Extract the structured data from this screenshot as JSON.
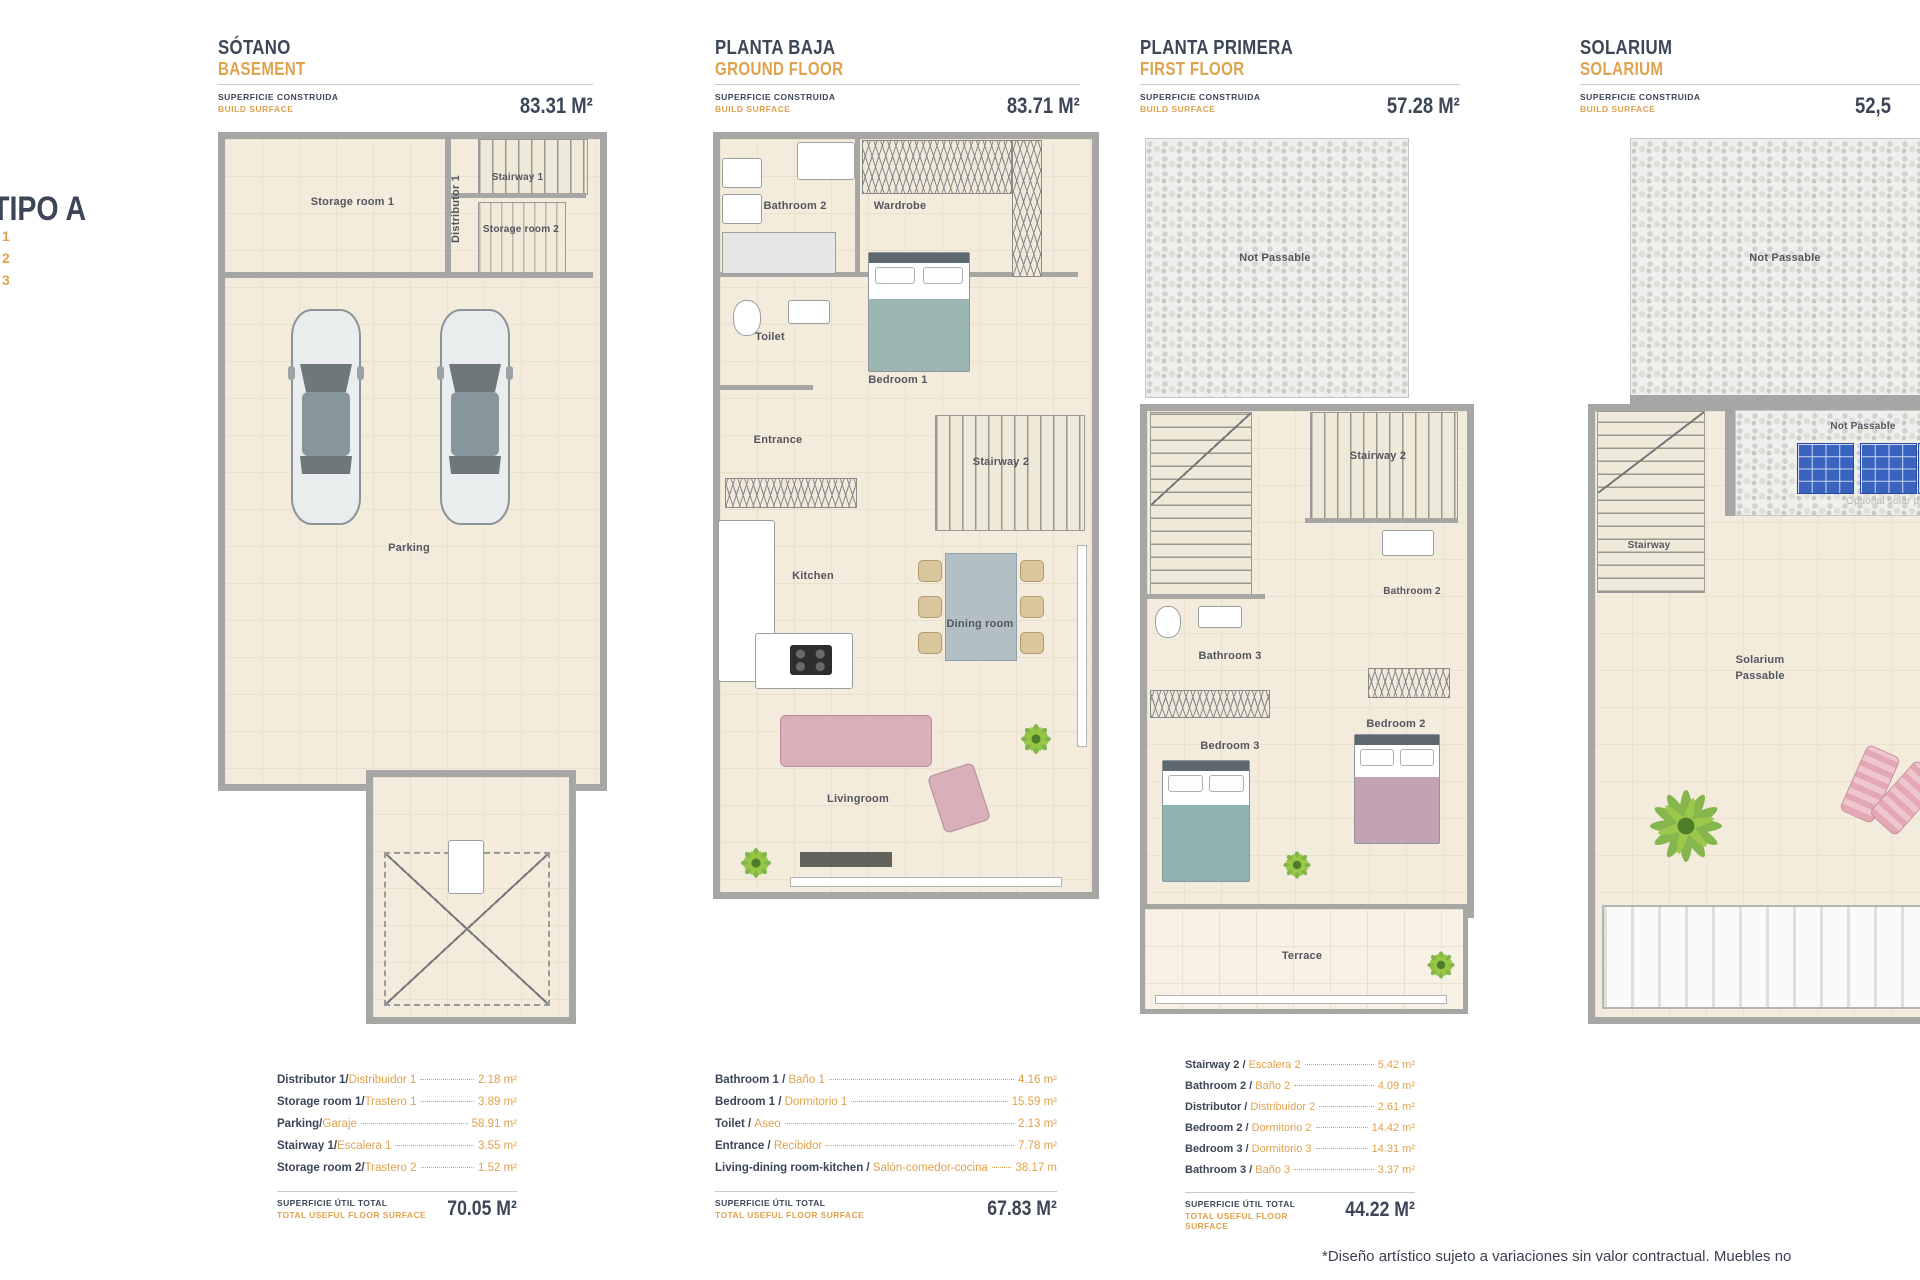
{
  "sidebar": {
    "type_title": "TIPO A",
    "list_items": [
      "1",
      "2",
      "3"
    ]
  },
  "shared": {
    "build_surface_es": "SUPERFICIE CONSTRUIDA",
    "build_surface_en": "BUILD SURFACE",
    "total_es": "SUPERFICIE ÚTIL TOTAL",
    "total_en": "TOTAL USEFUL FLOOR SURFACE"
  },
  "colors": {
    "navy": "#3c4657",
    "orange": "#dfa24d",
    "floor": "#f3ecdc",
    "wall": "#a6a6a4",
    "panel_blue": "#3a63c0",
    "plant_green": "#7cb342"
  },
  "plans": [
    {
      "title_es": "SÓTANO",
      "title_en": "BASEMENT",
      "area": "83.31 M²",
      "rooms": {
        "storage1": "Storage room 1",
        "distributor1": "Distributor 1",
        "stairway1": "Stairway 1",
        "storage2": "Storage room 2",
        "parking": "Parking"
      },
      "table": {
        "rows": [
          {
            "en": "Distributor 1/",
            "es": "Distribuidor 1",
            "value": "2.18 m²"
          },
          {
            "en": "Storage room 1/",
            "es": "Trastero 1",
            "value": "3.89 m²"
          },
          {
            "en": "Parking/",
            "es": "Garaje",
            "value": "58.91 m²"
          },
          {
            "en": "Stairway 1/",
            "es": "Escalera 1",
            "value": "3.55 m²"
          },
          {
            "en": "Storage room 2/",
            "es": "Trastero 2",
            "value": "1.52 m²"
          }
        ],
        "total": "70.05 M²"
      }
    },
    {
      "title_es": "PLANTA BAJA",
      "title_en": "GROUND FLOOR",
      "area": "83.71 M²",
      "rooms": {
        "bathroom2": "Bathroom 2",
        "wardrobe": "Wardrobe",
        "bedroom1": "Bedroom 1",
        "toilet": "Toilet",
        "entrance": "Entrance",
        "stairway2": "Stairway 2",
        "kitchen": "Kitchen",
        "dining": "Dining room",
        "living": "Livingroom"
      },
      "table": {
        "rows": [
          {
            "en": "Bathroom 1 / ",
            "es": "Baño 1",
            "value": "4.16 m²"
          },
          {
            "en": "Bedroom 1 / ",
            "es": "Dormitorio 1",
            "value": "15.59 m²"
          },
          {
            "en": "Toilet / ",
            "es": "Aseo",
            "value": "2.13 m²"
          },
          {
            "en": "Entrance / ",
            "es": "Recibidor",
            "value": "7.78 m²"
          },
          {
            "en": "Living-dining room-kitchen / ",
            "es": "Salón-comedor-cocina",
            "value": "38.17 m"
          }
        ],
        "total": "67.83 M²"
      }
    },
    {
      "title_es": "PLANTA PRIMERA",
      "title_en": "FIRST FLOOR",
      "area": "57.28 M²",
      "rooms": {
        "not_passable": "Not Passable",
        "stairway2": "Stairway 2",
        "bathroom2": "Bathroom 2",
        "bathroom3": "Bathroom 3",
        "bedroom3": "Bedroom 3",
        "bedroom2": "Bedroom 2",
        "terrace": "Terrace"
      },
      "table": {
        "rows": [
          {
            "en": "Stairway 2 / ",
            "es": "Escalera 2",
            "value": "5.42 m²"
          },
          {
            "en": "Bathroom 2 / ",
            "es": "Baño 2",
            "value": "4.09 m²"
          },
          {
            "en": "Distributor / ",
            "es": "Distribuidor 2",
            "value": "2.61 m²"
          },
          {
            "en": "Bedroom 2 / ",
            "es": "Dormitorio 2",
            "value": "14.42 m²"
          },
          {
            "en": "Bedroom 3 / ",
            "es": "Dormitorio 3",
            "value": "14.31 m²"
          },
          {
            "en": "Bathroom 3 / ",
            "es": "Baño 3",
            "value": "3.37 m²"
          }
        ],
        "total": "44.22 M²"
      }
    },
    {
      "title_es": "SOLARIUM",
      "title_en": "SOLARIUM",
      "area": "52,5",
      "rooms": {
        "not_passable_top": "Not Passable",
        "not_passable_right": "Not Passable",
        "optional_solar": "Optional solar pa",
        "stairway": "Stairway",
        "solarium_line1": "Solarium",
        "solarium_line2": "Passable"
      }
    }
  ],
  "footer": {
    "disclaimer": "*Diseño artístico sujeto a variaciones sin valor contractual. Muebles no"
  }
}
